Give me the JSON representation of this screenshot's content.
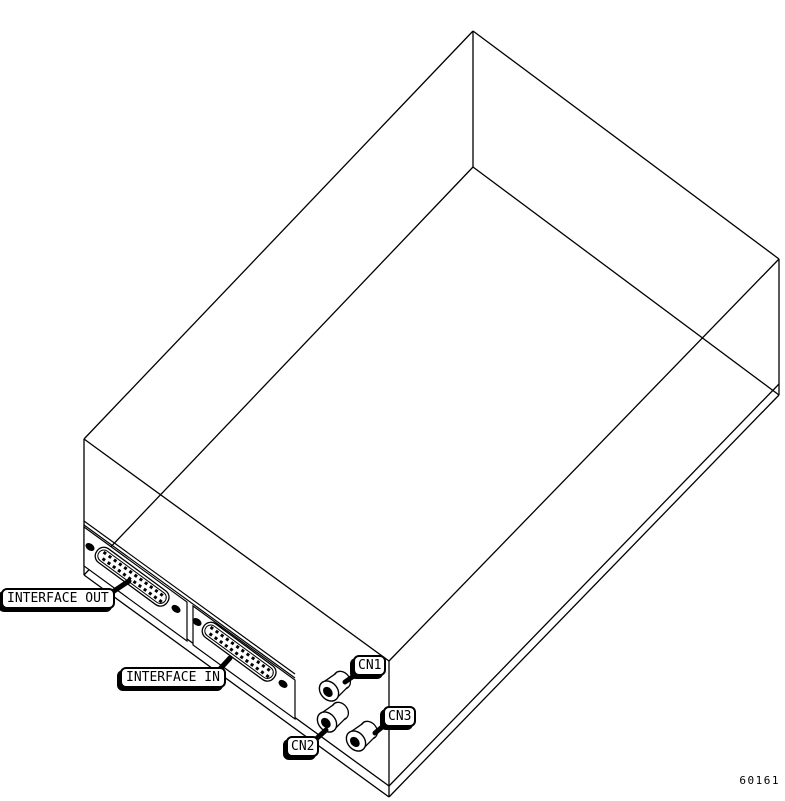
{
  "figure": {
    "number": "60161",
    "description": "Isometric line drawing of device chassis rear connectors"
  },
  "callouts": {
    "interface_out": {
      "label": "INTERFACE OUT"
    },
    "interface_in": {
      "label": "INTERFACE IN"
    },
    "cn1": {
      "label": "CN1"
    },
    "cn2": {
      "label": "CN2"
    },
    "cn3": {
      "label": "CN3"
    }
  },
  "colors": {
    "line": "#000000",
    "background": "#ffffff"
  }
}
